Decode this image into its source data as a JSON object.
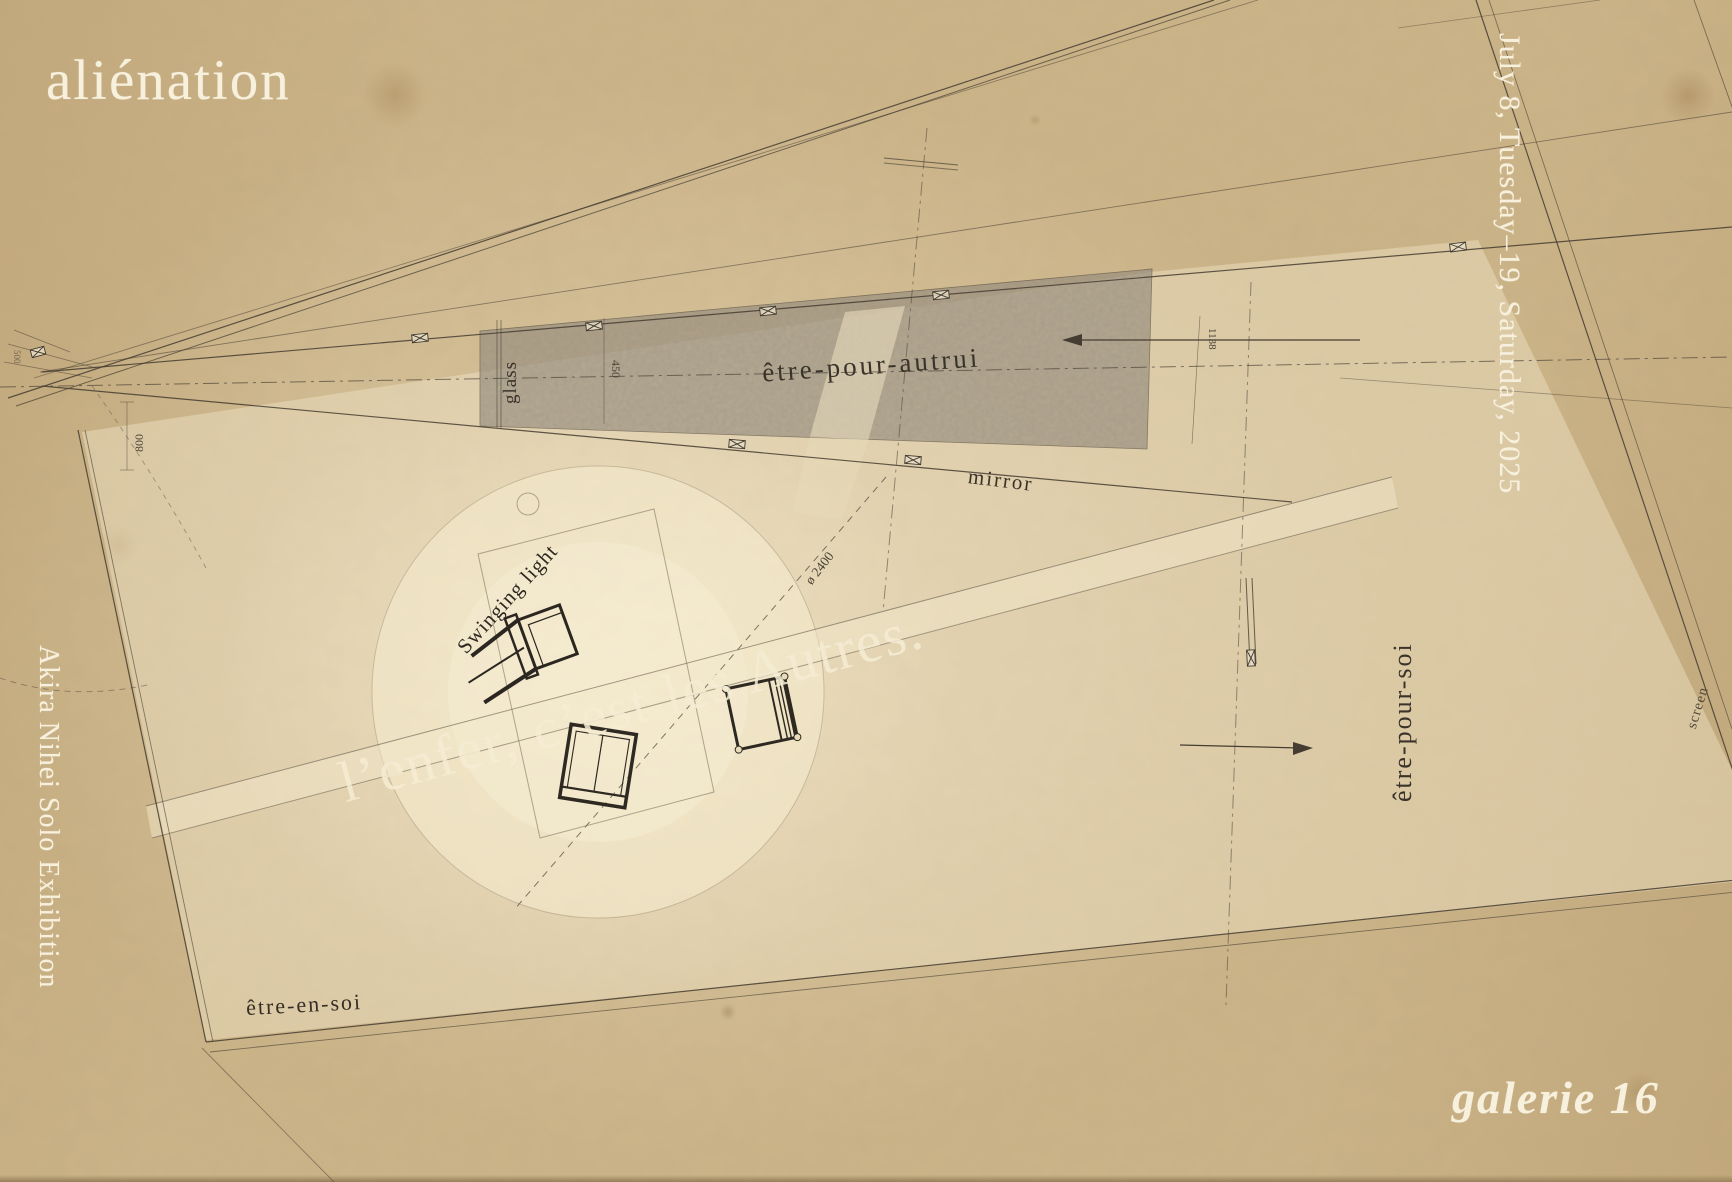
{
  "poster": {
    "title": "aliénation",
    "date": "July 8, Tuesday–19, Saturday, 2025",
    "artist": "Akira Nihei Solo Exhibition",
    "venue": "galerie 16",
    "watermark": "l’enfer, c’est les Autres."
  },
  "plan": {
    "zone_wall": "être-pour-autrui",
    "mirror": "mirror",
    "glass": "glass",
    "swinging_light": "Swinging light",
    "diameter": "ø 2400",
    "zone_right": "être-pour-soi",
    "screen": "screen",
    "zone_floor": "être-en-soi",
    "dim_450": "450",
    "dim_1138": "1138",
    "dim_800": "800",
    "dim_500": "500"
  },
  "colors": {
    "paper": "#cbb388",
    "ink": "#3a332a",
    "poster_text": "#f7f0dd",
    "mirror_band": "#948b7c",
    "watermark": "#f3e8c9"
  }
}
